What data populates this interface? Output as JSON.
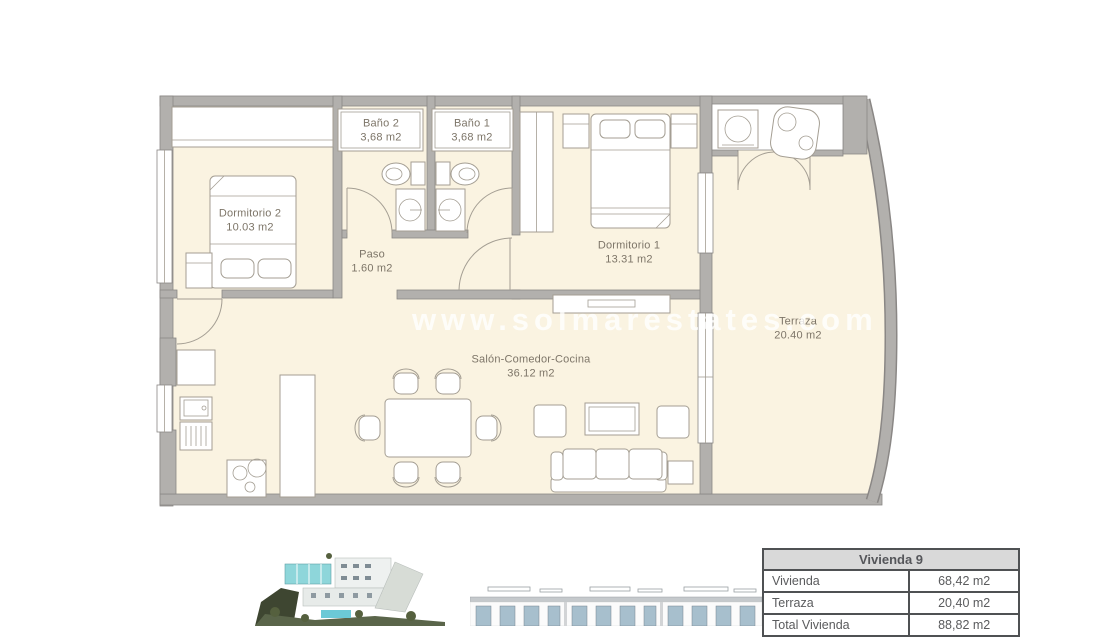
{
  "floor_plan": {
    "watermark": "www.solmarestates.com",
    "rooms": [
      {
        "name": "Dormitorio 2",
        "area": "10.03 m2"
      },
      {
        "name": "Baño 2",
        "area": "3,68 m2"
      },
      {
        "name": "Baño 1",
        "area": "3,68 m2"
      },
      {
        "name": "Paso",
        "area": "1.60 m2"
      },
      {
        "name": "Dormitorio 1",
        "area": "13.31 m2"
      },
      {
        "name": "Salón-Comedor-Cocina",
        "area": "36.12 m2"
      },
      {
        "name": "Terraza",
        "area": "20.40 m2"
      }
    ],
    "colors": {
      "floor": "#faf3e1",
      "walls": "#b2b0ad",
      "wall_outline": "#8a8785",
      "furniture_line": "#a49e93",
      "label_text": "#7d7568"
    }
  },
  "summary_table": {
    "title": "Vivienda 9",
    "rows": [
      {
        "label": "Vivienda",
        "value": "68,42 m2"
      },
      {
        "label": "Terraza",
        "value": "20,40 m2"
      },
      {
        "label": "Total Vivienda",
        "value": "88,82 m2"
      }
    ],
    "header_bg": "#d9d9d9",
    "border_color": "#4f5153"
  },
  "figures": {
    "aerial": "aerial-view-of-residential-complex",
    "facade": "front-elevation-of-apartments"
  }
}
